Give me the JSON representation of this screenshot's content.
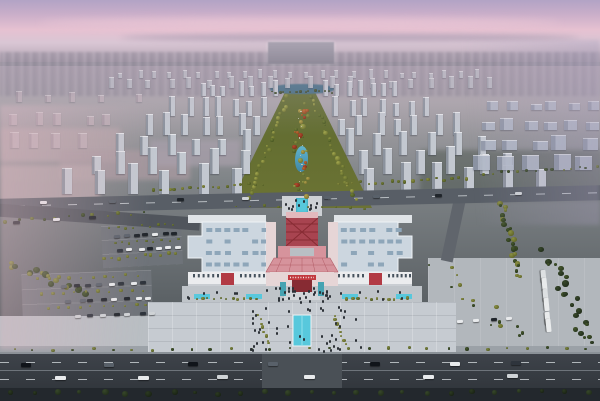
{
  "meta": {
    "description": "Aerial dusk rendering of a planned urban district: pink-violet sky, hazy city skyline, rows of high-rise towers flanking a long central landscaped park axis with ponds, and a large white exhibition complex with a red Chinese-style central gate tower, front plaza with reflecting pool, parking lots and tree-lined arterial roads in the foreground.",
    "visible_text": "none (distant signage illegible)"
  },
  "palette": {
    "skyTop": "#b2a3c5",
    "skyViolet": "#c9aec9",
    "skyPink": "#e6c1d1",
    "skyLight": "#d9c6d4",
    "horizonHaze": "#b2a4b2",
    "cityFar": "#a89fab",
    "groundTop": "#a8a3a9",
    "groundMid": "#7f8487",
    "groundLow": "#5a6064",
    "groundDark": "#363b40",
    "parkTop": "#5d6a30",
    "parkMid": "#6d7434",
    "parkLow": "#77793a",
    "lake": "#3f6a82",
    "pond": "#51a3bf",
    "poolCyan": "#58c8dc",
    "roadMid": "#585e66",
    "roadDark": "#3e434a",
    "roadDarker": "#32373d",
    "lane": "#ced3d7",
    "sidewalk": "#979da3",
    "roofLight": "#ccd6df",
    "roofEdge": "#eef2f6",
    "skylight": "#8ea6b9",
    "facade": "#ebecee",
    "facadeShade": "#c9cdd2",
    "windowDark": "#46525d",
    "redMain": "#b23a44",
    "redDark": "#872b33",
    "pinkRoof": "#d6939c",
    "pinkWall": "#e6d5d6",
    "redSign": "#c2393f",
    "teal": "#46a3b2",
    "plaza": "#c6cbd1",
    "apron": "#bfc4c9",
    "asphaltLot": "#6e7379",
    "plazaRight": "#b2b7bc",
    "hazePink": "rgba(223,185,196,0.45)",
    "hazeViolet": "rgba(166,156,185,0.38)"
  },
  "scene": {
    "towerFields": [
      {
        "name": "skyline-far-center",
        "rows": 2,
        "y0": 78,
        "y1": 88,
        "xa0": 115,
        "xa1": 100,
        "xb0": 485,
        "xb1": 500,
        "n0": 24,
        "n1": 20,
        "w0": 4,
        "w1": 5,
        "h0": 7,
        "h1": 10,
        "face": "#b9bdc5",
        "side": "#9aa0aa",
        "op": 0.85,
        "jit": 6
      },
      {
        "name": "towers-left-of-axis",
        "rows": 6,
        "y0": 96,
        "y1": 194,
        "xa0": 196,
        "xa1": 48,
        "xb0": 280,
        "xb1": 252,
        "n0": 7,
        "n1": 6,
        "w0": 5,
        "w1": 10,
        "h0": 13,
        "h1": 27,
        "face": "#c3c8d0",
        "side": "#8b929d",
        "op": 1,
        "jit": 8
      },
      {
        "name": "towers-right-of-axis",
        "rows": 6,
        "y0": 96,
        "y1": 194,
        "xa0": 321,
        "xa1": 352,
        "xb0": 402,
        "xb1": 556,
        "n0": 7,
        "n1": 6,
        "w0": 5,
        "w1": 10,
        "h0": 13,
        "h1": 27,
        "face": "#c3c8d0",
        "side": "#8b929d",
        "op": 1,
        "jit": 8
      },
      {
        "name": "towers-left-haze",
        "rows": 3,
        "y0": 102,
        "y1": 148,
        "xa0": 0,
        "xa1": 0,
        "xb0": 150,
        "xb1": 95,
        "n0": 5,
        "n1": 4,
        "w0": 6,
        "w1": 9,
        "h0": 9,
        "h1": 15,
        "face": "#c5b4bd",
        "side": "#a394a0",
        "op": 0.6,
        "jit": 10
      },
      {
        "name": "slab-blocks-right",
        "rows": 4,
        "y0": 110,
        "y1": 170,
        "xa0": 486,
        "xa1": 468,
        "xb0": 600,
        "xb1": 600,
        "n0": 6,
        "n1": 5,
        "w0": 11,
        "w1": 17,
        "h0": 8,
        "h1": 14,
        "face": "#b3bac9",
        "side": "#8f97a8",
        "op": 0.9,
        "jit": 8
      }
    ],
    "treeBelts": [
      {
        "name": "park-left-edge",
        "x0": 288,
        "y0": 96,
        "x1": 247,
        "y1": 200,
        "n": 26,
        "r0": 2,
        "r1": 5,
        "spread": 5,
        "colors": [
          [
            "#8a9040",
            "#4e5a24"
          ],
          [
            "#6f7c36",
            "#3e4d1e"
          ],
          [
            "#a3a84e",
            "#5f6428"
          ]
        ]
      },
      {
        "name": "park-right-edge",
        "x0": 312,
        "y0": 96,
        "x1": 355,
        "y1": 200,
        "n": 26,
        "r0": 2,
        "r1": 5,
        "spread": 5,
        "colors": [
          [
            "#8a9040",
            "#4e5a24"
          ],
          [
            "#6f7c36",
            "#3e4d1e"
          ],
          [
            "#a3a84e",
            "#5f6428"
          ]
        ]
      },
      {
        "name": "park-center-gardens",
        "x0": 300,
        "y0": 102,
        "x1": 301,
        "y1": 196,
        "n": 34,
        "r0": 2,
        "r1": 6,
        "spread": 16,
        "colors": [
          [
            "#a3a84e",
            "#5f6428"
          ],
          [
            "#8a9040",
            "#4e5a24"
          ],
          [
            "#b5a44c",
            "#6e6529"
          ],
          [
            "#6f7c36",
            "#3e4d1e"
          ],
          [
            "#c06a33",
            "#7e3a1a"
          ],
          [
            "#b44a2e",
            "#6e2714"
          ]
        ]
      },
      {
        "name": "park-path-glints",
        "x0": 300,
        "y0": 106,
        "x1": 301,
        "y1": 194,
        "n": 10,
        "r0": 1,
        "r1": 2,
        "spread": 4,
        "colors": [
          [
            "#d9d6c9",
            "#b5b2a6"
          ]
        ]
      },
      {
        "name": "park-top-band",
        "x0": 268,
        "y0": 92,
        "x1": 336,
        "y1": 92,
        "n": 14,
        "r0": 2,
        "r1": 3,
        "spread": 4,
        "colors": [
          [
            "#45562c",
            "#22301a"
          ]
        ]
      },
      {
        "name": "crossroad-north-left",
        "x0": 150,
        "y0": 190,
        "x1": 268,
        "y1": 184,
        "n": 16,
        "r0": 2,
        "r1": 4,
        "spread": 4,
        "colors": [
          [
            "#8a8f44",
            "#53591f"
          ],
          [
            "#747e38",
            "#434d1c"
          ]
        ]
      },
      {
        "name": "crossroad-north-right",
        "x0": 335,
        "y0": 184,
        "x1": 470,
        "y1": 178,
        "n": 18,
        "r0": 2,
        "r1": 4,
        "spread": 4,
        "colors": [
          [
            "#8a8f44",
            "#53591f"
          ],
          [
            "#747e38",
            "#434d1c"
          ]
        ]
      },
      {
        "name": "far-right-road-row",
        "x0": 480,
        "y0": 175,
        "x1": 600,
        "y1": 166,
        "n": 14,
        "r0": 2,
        "r1": 4,
        "spread": 5,
        "colors": [
          [
            "#747e38",
            "#434d1c"
          ],
          [
            "#45562c",
            "#22301a"
          ]
        ]
      },
      {
        "name": "right-vertical-belt",
        "x0": 500,
        "y0": 200,
        "x1": 522,
        "y1": 278,
        "n": 24,
        "r0": 3,
        "r1": 6,
        "spread": 8,
        "colors": [
          [
            "#8a8f44",
            "#53591f"
          ],
          [
            "#45562c",
            "#22301a"
          ]
        ]
      },
      {
        "name": "right-grove",
        "x0": 548,
        "y0": 252,
        "x1": 592,
        "y1": 348,
        "n": 22,
        "r0": 3,
        "r1": 7,
        "spread": 16,
        "colors": [
          [
            "#45562c",
            "#22301a"
          ],
          [
            "#37472a",
            "#1b2616"
          ]
        ]
      },
      {
        "name": "bottom-left-grove",
        "x0": 8,
        "y0": 262,
        "x1": 88,
        "y1": 296,
        "n": 16,
        "r0": 4,
        "r1": 8,
        "spread": 12,
        "colors": [
          [
            "#8a8f44",
            "#53591f"
          ],
          [
            "#45562c",
            "#22301a"
          ]
        ]
      },
      {
        "name": "left-road-south-row",
        "x0": 0,
        "y0": 222,
        "x1": 150,
        "y1": 212,
        "n": 12,
        "r0": 2,
        "r1": 5,
        "spread": 5,
        "colors": [
          [
            "#747e38",
            "#434d1c"
          ],
          [
            "#45562c",
            "#22301a"
          ]
        ]
      },
      {
        "name": "nw-lot-diag-row",
        "x0": 100,
        "y0": 260,
        "x1": 180,
        "y1": 252,
        "n": 10,
        "r0": 2,
        "r1": 4,
        "spread": 4,
        "colors": [
          [
            "#8a8f44",
            "#53591f"
          ]
        ]
      },
      {
        "name": "apron-left-planters",
        "x0": 193,
        "y0": 299,
        "x1": 260,
        "y1": 299,
        "n": 11,
        "r0": 2,
        "r1": 4,
        "spread": 2,
        "colors": [
          [
            "#8a8f44",
            "#53591f"
          ],
          [
            "#747e38",
            "#434d1c"
          ]
        ]
      },
      {
        "name": "apron-right-planters",
        "x0": 344,
        "y0": 299,
        "x1": 410,
        "y1": 299,
        "n": 11,
        "r0": 2,
        "r1": 4,
        "spread": 2,
        "colors": [
          [
            "#8a8f44",
            "#53591f"
          ],
          [
            "#747e38",
            "#434d1c"
          ]
        ]
      },
      {
        "name": "plaza-left-tree-column",
        "x0": 258,
        "y0": 314,
        "x1": 270,
        "y1": 346,
        "n": 8,
        "r0": 2,
        "r1": 4,
        "spread": 3,
        "colors": [
          [
            "#8a8f44",
            "#53591f"
          ]
        ]
      },
      {
        "name": "plaza-right-tree-column",
        "x0": 334,
        "y0": 314,
        "x1": 346,
        "y1": 346,
        "n": 8,
        "r0": 2,
        "r1": 4,
        "spread": 3,
        "colors": [
          [
            "#8a8f44",
            "#53591f"
          ]
        ]
      },
      {
        "name": "sidewalk-row",
        "x0": 4,
        "y0": 350,
        "x1": 596,
        "y1": 348,
        "n": 30,
        "r0": 2,
        "r1": 4,
        "spread": 3,
        "colors": [
          [
            "#7d8640",
            "#47511f"
          ],
          [
            "#45562c",
            "#22301a"
          ]
        ]
      },
      {
        "name": "bottom-edge-trees",
        "x0": 0,
        "y0": 394,
        "x1": 600,
        "y1": 392,
        "n": 26,
        "r0": 4,
        "r1": 7,
        "spread": 4,
        "colors": [
          [
            "#37472a",
            "#1b2616"
          ],
          [
            "#2c3a22",
            "#141c10"
          ]
        ]
      },
      {
        "name": "sw-lot-row-1",
        "x0": 32,
        "y0": 279,
        "x1": 142,
        "y1": 275,
        "n": 10,
        "r0": 2,
        "r1": 4,
        "spread": 3,
        "colors": [
          [
            "#8a8f44",
            "#53591f"
          ]
        ]
      },
      {
        "name": "sw-lot-row-2",
        "x0": 36,
        "y0": 294,
        "x1": 148,
        "y1": 290,
        "n": 10,
        "r0": 2,
        "r1": 4,
        "spread": 3,
        "colors": [
          [
            "#8a8f44",
            "#53591f"
          ]
        ]
      },
      {
        "name": "sw-lot-row-3",
        "x0": 42,
        "y0": 309,
        "x1": 152,
        "y1": 305,
        "n": 10,
        "r0": 2,
        "r1": 4,
        "spread": 3,
        "colors": [
          [
            "#8a8f44",
            "#53591f"
          ]
        ]
      },
      {
        "name": "nw-lot-row-1",
        "x0": 106,
        "y0": 229,
        "x1": 178,
        "y1": 224,
        "n": 9,
        "r0": 2,
        "r1": 3,
        "spread": 3,
        "colors": [
          [
            "#747e38",
            "#434d1c"
          ]
        ]
      },
      {
        "name": "nw-lot-row-2",
        "x0": 110,
        "y0": 244,
        "x1": 182,
        "y1": 239,
        "n": 9,
        "r0": 2,
        "r1": 3,
        "spread": 3,
        "colors": [
          [
            "#747e38",
            "#434d1c"
          ]
        ]
      },
      {
        "name": "right-plaza-scatter",
        "x0": 436,
        "y0": 268,
        "x1": 524,
        "y1": 340,
        "n": 16,
        "r0": 2,
        "r1": 5,
        "spread": 22,
        "colors": [
          [
            "#8a8f44",
            "#53591f"
          ],
          [
            "#45562c",
            "#22301a"
          ]
        ]
      },
      {
        "name": "complex-flank-green",
        "x0": 230,
        "y0": 206,
        "x1": 372,
        "y1": 208,
        "n": 10,
        "r0": 1,
        "r1": 3,
        "spread": 3,
        "colors": [
          [
            "#747e38",
            "#434d1c"
          ]
        ]
      }
    ],
    "carBelts": [
      {
        "name": "bottom-road-lane-1",
        "x0": 14,
        "y0": 363,
        "x1": 586,
        "y1": 361,
        "n": 7,
        "w": 10,
        "h": 4,
        "colors": [
          "#20252b",
          "#e8eaec",
          "#59616a",
          "#2e343c",
          "#10141a"
        ]
      },
      {
        "name": "bottom-road-lane-2",
        "x0": 24,
        "y0": 376,
        "x1": 576,
        "y1": 374,
        "n": 6,
        "w": 11,
        "h": 4,
        "colors": [
          "#e8eaec",
          "#20252b",
          "#cfd3d6",
          "#2e343c"
        ]
      },
      {
        "name": "cross-road-traffic",
        "x0": 30,
        "y0": 201,
        "x1": 570,
        "y1": 191,
        "n": 8,
        "w": 7,
        "h": 3,
        "colors": [
          "#20252b",
          "#e8eaec",
          "#59616a",
          "#cfd3d6"
        ]
      },
      {
        "name": "sw-lot-cars-1",
        "x0": 58,
        "y0": 285,
        "x1": 150,
        "y1": 281,
        "n": 8,
        "w": 6,
        "h": 3,
        "colors": [
          "#20252b",
          "#e8eaec",
          "#59616a",
          "#2e343c"
        ]
      },
      {
        "name": "sw-lot-cars-2",
        "x0": 64,
        "y0": 300,
        "x1": 156,
        "y1": 296,
        "n": 8,
        "w": 6,
        "h": 3,
        "colors": [
          "#e8eaec",
          "#20252b",
          "#59616a"
        ]
      },
      {
        "name": "sw-lot-cars-3",
        "x0": 70,
        "y0": 315,
        "x1": 162,
        "y1": 311,
        "n": 7,
        "w": 6,
        "h": 3,
        "colors": [
          "#20252b",
          "#cfd3d6",
          "#2e343c"
        ]
      },
      {
        "name": "nw-lot-cars-1",
        "x0": 112,
        "y0": 235,
        "x1": 180,
        "y1": 231,
        "n": 7,
        "w": 6,
        "h": 3,
        "colors": [
          "#e8eaec",
          "#20252b",
          "#59616a"
        ]
      },
      {
        "name": "nw-lot-cars-2",
        "x0": 116,
        "y0": 249,
        "x1": 184,
        "y1": 245,
        "n": 7,
        "w": 6,
        "h": 3,
        "colors": [
          "#20252b",
          "#e8eaec",
          "#2e343c"
        ]
      },
      {
        "name": "bus-parking-column",
        "x0": 537,
        "y0": 271,
        "x1": 543,
        "y1": 333,
        "n": 6,
        "w": 13,
        "h": 5,
        "colors": [
          "#e9ebec",
          "#dde0e2"
        ]
      },
      {
        "name": "left-road-cars",
        "x0": 8,
        "y0": 221,
        "x1": 120,
        "y1": 214,
        "n": 3,
        "w": 7,
        "h": 3,
        "colors": [
          "#e8eaec",
          "#20252b"
        ]
      },
      {
        "name": "right-plaza-cars",
        "x0": 450,
        "y0": 320,
        "x1": 520,
        "y1": 316,
        "n": 4,
        "w": 6,
        "h": 3,
        "colors": [
          "#20252b",
          "#e8eaec"
        ]
      }
    ],
    "peopleAreas": [
      {
        "name": "front-plaza-crowd",
        "x": 242,
        "y": 306,
        "w": 118,
        "h": 44,
        "n": 46
      },
      {
        "name": "entrance-crowd",
        "x": 274,
        "y": 286,
        "w": 56,
        "h": 16,
        "n": 26
      },
      {
        "name": "rear-plaza-people",
        "x": 283,
        "y": 198,
        "w": 38,
        "h": 16,
        "n": 12
      },
      {
        "name": "apron-walk-people",
        "x": 186,
        "y": 288,
        "w": 230,
        "h": 10,
        "n": 18
      }
    ],
    "skylightGrids": [
      {
        "name": "left-wing-skylights",
        "x0": 206,
        "y0": 228,
        "cols": 7,
        "rows": 4,
        "dx": 9.2,
        "dy": 11.5,
        "w": 6,
        "h": 4
      },
      {
        "name": "right-wing-skylights",
        "x0": 341,
        "y0": 228,
        "cols": 7,
        "rows": 4,
        "dx": 9.2,
        "dy": 11.5,
        "w": 6,
        "h": 4
      }
    ],
    "windowStrips": [
      {
        "name": "left-wing-windows-a",
        "x0": 193,
        "x1": 217,
        "y": 274,
        "n": 6
      },
      {
        "name": "left-wing-windows-b",
        "x0": 240,
        "x1": 263,
        "y": 274,
        "n": 6
      },
      {
        "name": "right-wing-windows-a",
        "x0": 338,
        "x1": 362,
        "y": 274,
        "n": 6
      },
      {
        "name": "right-wing-windows-b",
        "x0": 388,
        "x1": 409,
        "y": 274,
        "n": 6
      }
    ]
  }
}
